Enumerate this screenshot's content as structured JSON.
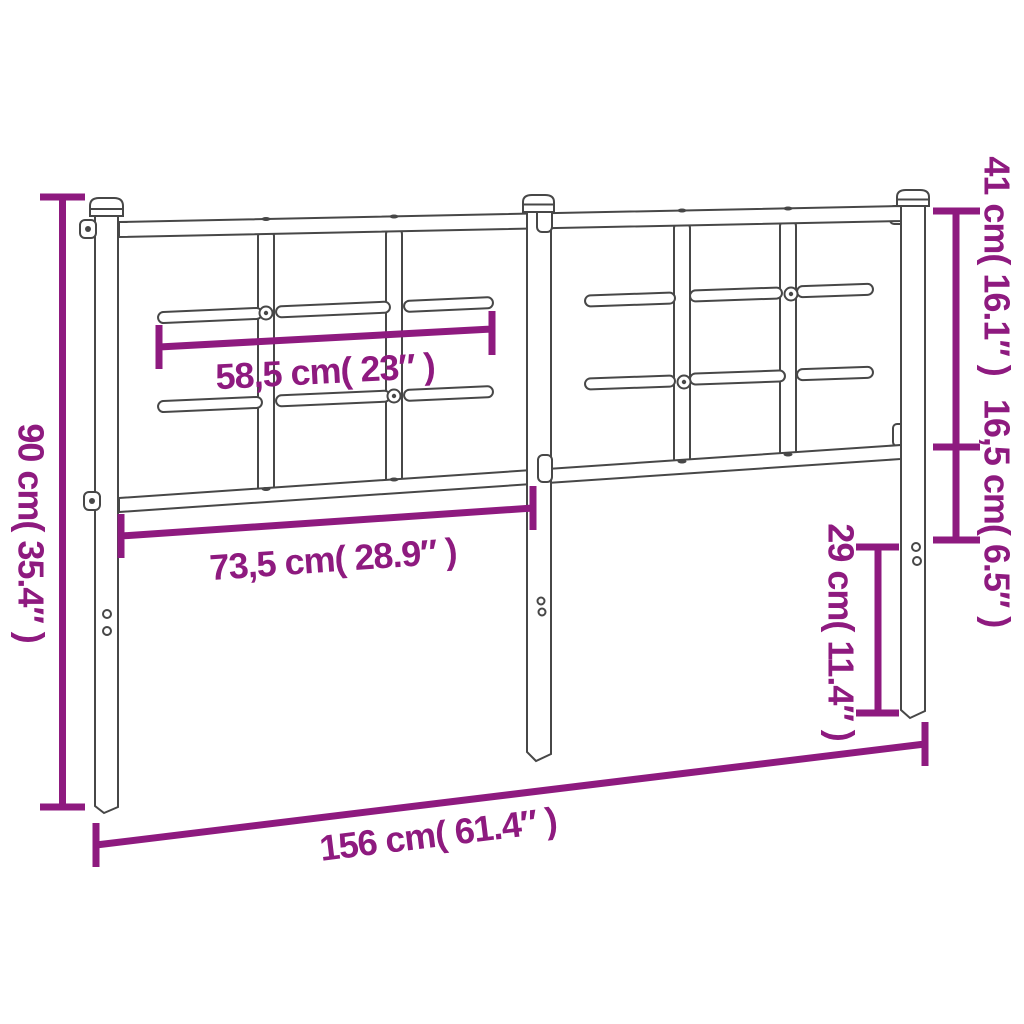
{
  "diagram": {
    "subject": "metal headboard technical dimension drawing",
    "background_color": "#ffffff",
    "outline_color": "#474747",
    "dimension_color": "#8e1a7f",
    "labels": {
      "total_height": "90 cm( 35.4″ )",
      "upper_slat_span": "58,5 cm( 23″ )",
      "lower_rail_span": "73,5 cm( 28.9″ )",
      "total_width": "156 cm( 61.4″ )",
      "top_section_height": "41 cm( 16.1″ )",
      "middle_section_height": "16,5 cm( 6.5″ )",
      "leg_height": "29 cm( 11.4″ )"
    }
  }
}
